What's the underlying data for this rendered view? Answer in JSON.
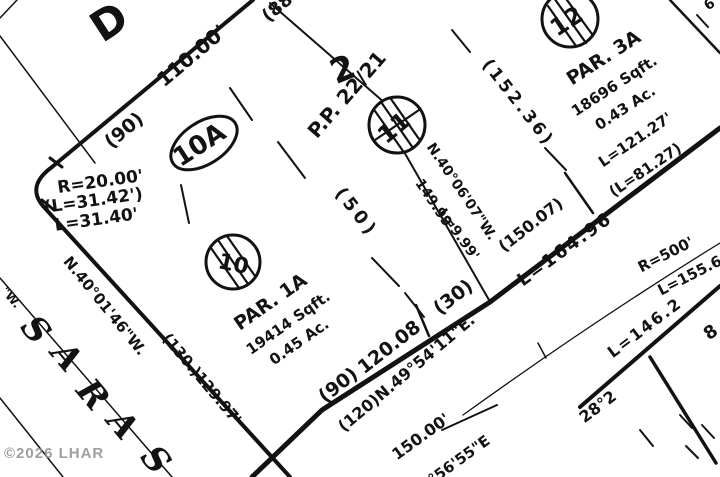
{
  "canvas": {
    "width": 720,
    "height": 477,
    "paper": "#ffffff",
    "ink": "#121212"
  },
  "watermark": {
    "text": "©2026 LHAR",
    "color": "#8f8f8f"
  },
  "plat": {
    "paths": [
      {
        "d": "M52,167 Q26,186 43,206",
        "w": 4,
        "n": "corner-curve"
      },
      {
        "d": "M252,477 L322,410 L490,302 L720,128",
        "w": 5,
        "n": "road-edge-line"
      },
      {
        "d": "M463,415 Q595,320 720,243",
        "w": 1.3,
        "n": "road-centerline-curve"
      }
    ],
    "lines": [
      [
        52,
        167,
        253,
        0,
        4
      ],
      [
        43,
        206,
        290,
        477,
        4
      ],
      [
        270,
        3,
        385,
        103,
        2
      ],
      [
        403,
        150,
        489,
        300,
        2
      ],
      [
        0,
        36,
        95,
        163,
        1.5
      ],
      [
        0,
        18,
        17,
        0,
        1.5
      ],
      [
        0,
        278,
        172,
        477,
        1.5
      ],
      [
        0,
        398,
        63,
        477,
        1.5
      ],
      [
        580,
        407,
        720,
        286,
        4
      ],
      [
        650,
        357,
        716,
        463,
        3.5
      ],
      [
        670,
        0,
        720,
        53,
        2.5
      ],
      [
        416,
        305,
        429,
        336,
        2.5
      ],
      [
        565,
        173,
        593,
        213,
        2.5
      ],
      [
        538,
        343,
        546,
        358,
        1.5
      ],
      [
        442,
        430,
        497,
        405,
        2
      ],
      [
        50,
        158,
        62,
        167,
        3
      ],
      [
        42,
        200,
        54,
        210,
        3
      ]
    ],
    "dashes": [
      [
        230,
        88,
        252,
        120
      ],
      [
        278,
        142,
        305,
        178
      ],
      [
        372,
        258,
        399,
        286
      ],
      [
        405,
        293,
        424,
        317
      ],
      [
        181,
        185,
        189,
        223
      ],
      [
        452,
        30,
        470,
        52
      ],
      [
        545,
        148,
        566,
        170
      ],
      [
        680,
        415,
        692,
        428
      ],
      [
        702,
        425,
        714,
        438
      ],
      [
        686,
        446,
        698,
        458
      ],
      [
        640,
        430,
        653,
        446
      ],
      [
        697,
        15,
        708,
        27
      ]
    ],
    "circles": [
      {
        "cx": 233,
        "cy": 262,
        "r": 27
      },
      {
        "cx": 397,
        "cy": 125,
        "r": 28
      },
      {
        "cx": 570,
        "cy": 19,
        "r": 28
      }
    ],
    "hatches": [
      [
        227,
        236,
        255,
        276
      ],
      [
        218,
        240,
        248,
        284
      ],
      [
        211,
        248,
        239,
        288
      ],
      [
        391,
        99,
        419,
        139
      ],
      [
        381,
        102,
        413,
        148
      ],
      [
        375,
        111,
        403,
        151
      ],
      [
        375,
        140,
        419,
        110
      ],
      [
        564,
        -4,
        592,
        34
      ],
      [
        554,
        -2,
        586,
        43
      ],
      [
        548,
        6,
        576,
        46
      ]
    ],
    "ellipse": {
      "cx": 204,
      "cy": 143,
      "rx": 37,
      "ry": 21,
      "rot": -33,
      "w": 3
    },
    "labels": [
      {
        "t": "D",
        "x": 117,
        "y": 34,
        "r": -33,
        "s": 42,
        "b": true,
        "n": "street-letter-d"
      },
      {
        "t": "110.00'",
        "x": 196,
        "y": 61,
        "r": -40,
        "s": 20,
        "b": true
      },
      {
        "t": "(90)",
        "x": 128,
        "y": 135,
        "r": -40,
        "s": 19,
        "b": true
      },
      {
        "t": "(88",
        "x": 281,
        "y": 12,
        "r": -40,
        "s": 18,
        "b": true
      },
      {
        "t": "2",
        "x": 347,
        "y": 80,
        "r": -22,
        "s": 34,
        "b": true,
        "n": "lot-2-number"
      },
      {
        "t": "P.P. 22/21",
        "x": 352,
        "y": 99,
        "r": -49,
        "s": 20,
        "b": true,
        "n": "plat-reference"
      },
      {
        "t": "(152.36)",
        "x": 514,
        "y": 106,
        "r": 52,
        "s": 17,
        "b": true,
        "ls": 3
      },
      {
        "t": "R=20.00'",
        "x": 101,
        "y": 187,
        "r": -8,
        "s": 17,
        "b": true
      },
      {
        "t": "(L=31.42')",
        "x": 94,
        "y": 206,
        "r": -8,
        "s": 17,
        "b": true
      },
      {
        "t": "L=31.40'",
        "x": 97,
        "y": 225,
        "r": -8,
        "s": 17,
        "b": true
      },
      {
        "t": "N.40°01'46\"W.",
        "x": 101,
        "y": 309,
        "r": 51,
        "s": 15,
        "b": true
      },
      {
        "t": "(130.)129.97'",
        "x": 198,
        "y": 382,
        "r": 50,
        "s": 15,
        "b": true
      },
      {
        "t": "PAR. 1A",
        "x": 274,
        "y": 307,
        "r": -35,
        "s": 19,
        "b": true,
        "n": "parcel-1a-name"
      },
      {
        "t": "19414 Sqft.",
        "x": 291,
        "y": 327,
        "r": -35,
        "s": 15,
        "b": true,
        "n": "parcel-1a-area-sqft"
      },
      {
        "t": "0.45 Ac.",
        "x": 302,
        "y": 346,
        "r": -35,
        "s": 15,
        "b": true,
        "n": "parcel-1a-area-acres"
      },
      {
        "t": "PAR. 3A",
        "x": 607,
        "y": 63,
        "r": -33,
        "s": 19,
        "b": true,
        "n": "parcel-3a-name"
      },
      {
        "t": "18696 Sqft.",
        "x": 617,
        "y": 90,
        "r": -33,
        "s": 15,
        "b": true,
        "n": "parcel-3a-area-sqft"
      },
      {
        "t": "0.43 Ac.",
        "x": 628,
        "y": 112,
        "r": -33,
        "s": 15,
        "b": true,
        "n": "parcel-3a-area-acres"
      },
      {
        "t": "(50)",
        "x": 352,
        "y": 216,
        "r": 52,
        "s": 18,
        "b": true,
        "ls": 4
      },
      {
        "t": "N.40°06'07\"W.",
        "x": 458,
        "y": 194,
        "r": 56,
        "s": 14,
        "b": true
      },
      {
        "t": "149.99'",
        "x": 431,
        "y": 207,
        "r": 56,
        "s": 14,
        "b": true
      },
      {
        "t": "L=9.99'",
        "x": 455,
        "y": 237,
        "r": 54,
        "s": 14,
        "b": true
      },
      {
        "t": "(150.07)",
        "x": 534,
        "y": 229,
        "r": -38,
        "s": 16,
        "b": true
      },
      {
        "t": "(90)",
        "x": 342,
        "y": 390,
        "r": -38,
        "s": 19,
        "b": true
      },
      {
        "t": "120.08",
        "x": 393,
        "y": 352,
        "r": -38,
        "s": 19,
        "b": true
      },
      {
        "t": "(30)",
        "x": 457,
        "y": 302,
        "r": -38,
        "s": 19,
        "b": true
      },
      {
        "t": "(120)N.49°54'11\"E.",
        "x": 410,
        "y": 377,
        "r": -40,
        "s": 16,
        "b": true
      },
      {
        "t": "L=164.96",
        "x": 568,
        "y": 254,
        "r": -36,
        "s": 18,
        "b": true,
        "ls": 2
      },
      {
        "t": "L=121.27'",
        "x": 638,
        "y": 144,
        "r": -34,
        "s": 15,
        "b": true
      },
      {
        "t": "(L=81.27)",
        "x": 648,
        "y": 174,
        "r": -34,
        "s": 15,
        "b": true
      },
      {
        "t": "R=500'",
        "x": 668,
        "y": 259,
        "r": -27,
        "s": 15,
        "b": true
      },
      {
        "t": "L=155.6",
        "x": 692,
        "y": 280,
        "r": -27,
        "s": 15,
        "b": true
      },
      {
        "t": "L=146.2",
        "x": 648,
        "y": 332,
        "r": -37,
        "s": 16,
        "b": true,
        "ls": 2
      },
      {
        "t": "28°2",
        "x": 601,
        "y": 411,
        "r": -37,
        "s": 16,
        "b": true
      },
      {
        "t": "8",
        "x": 714,
        "y": 337,
        "r": -35,
        "s": 18,
        "b": true
      },
      {
        "t": "150.00'",
        "x": 424,
        "y": 441,
        "r": -36,
        "s": 16,
        "b": true
      },
      {
        "t": "°56'55\"E",
        "x": 462,
        "y": 464,
        "r": -36,
        "s": 15,
        "b": true
      },
      {
        "t": "\"W.",
        "x": 8,
        "y": 300,
        "r": 50,
        "s": 12,
        "b": true
      },
      {
        "t": "6",
        "x": 712,
        "y": 8,
        "r": -35,
        "s": 14,
        "b": true
      },
      {
        "t": "10A",
        "x": 204,
        "y": 152,
        "r": -33,
        "s": 26,
        "b": true,
        "n": "lot-10a-number"
      },
      {
        "t": "10",
        "x": 232,
        "y": 271,
        "r": 12,
        "s": 22,
        "b": true,
        "n": "lot-10-number"
      },
      {
        "t": "11",
        "x": 399,
        "y": 134,
        "r": -40,
        "s": 24,
        "b": true,
        "n": "lot-11-number"
      },
      {
        "t": "12",
        "x": 571,
        "y": 28,
        "r": -33,
        "s": 24,
        "b": true,
        "n": "lot-12-number"
      },
      {
        "t": "S",
        "x": 27,
        "y": 337,
        "r": 50,
        "s": 34,
        "b": true,
        "i": true,
        "n": "street-letter"
      },
      {
        "t": "A",
        "x": 58,
        "y": 364,
        "r": 50,
        "s": 34,
        "b": true,
        "i": true,
        "n": "street-letter"
      },
      {
        "t": "R",
        "x": 84,
        "y": 402,
        "r": 50,
        "s": 34,
        "b": true,
        "i": true,
        "n": "street-letter"
      },
      {
        "t": "A",
        "x": 114,
        "y": 432,
        "r": 50,
        "s": 34,
        "b": true,
        "i": true,
        "n": "street-letter"
      },
      {
        "t": "S",
        "x": 147,
        "y": 467,
        "r": 50,
        "s": 34,
        "b": true,
        "i": true,
        "n": "street-letter"
      }
    ]
  }
}
